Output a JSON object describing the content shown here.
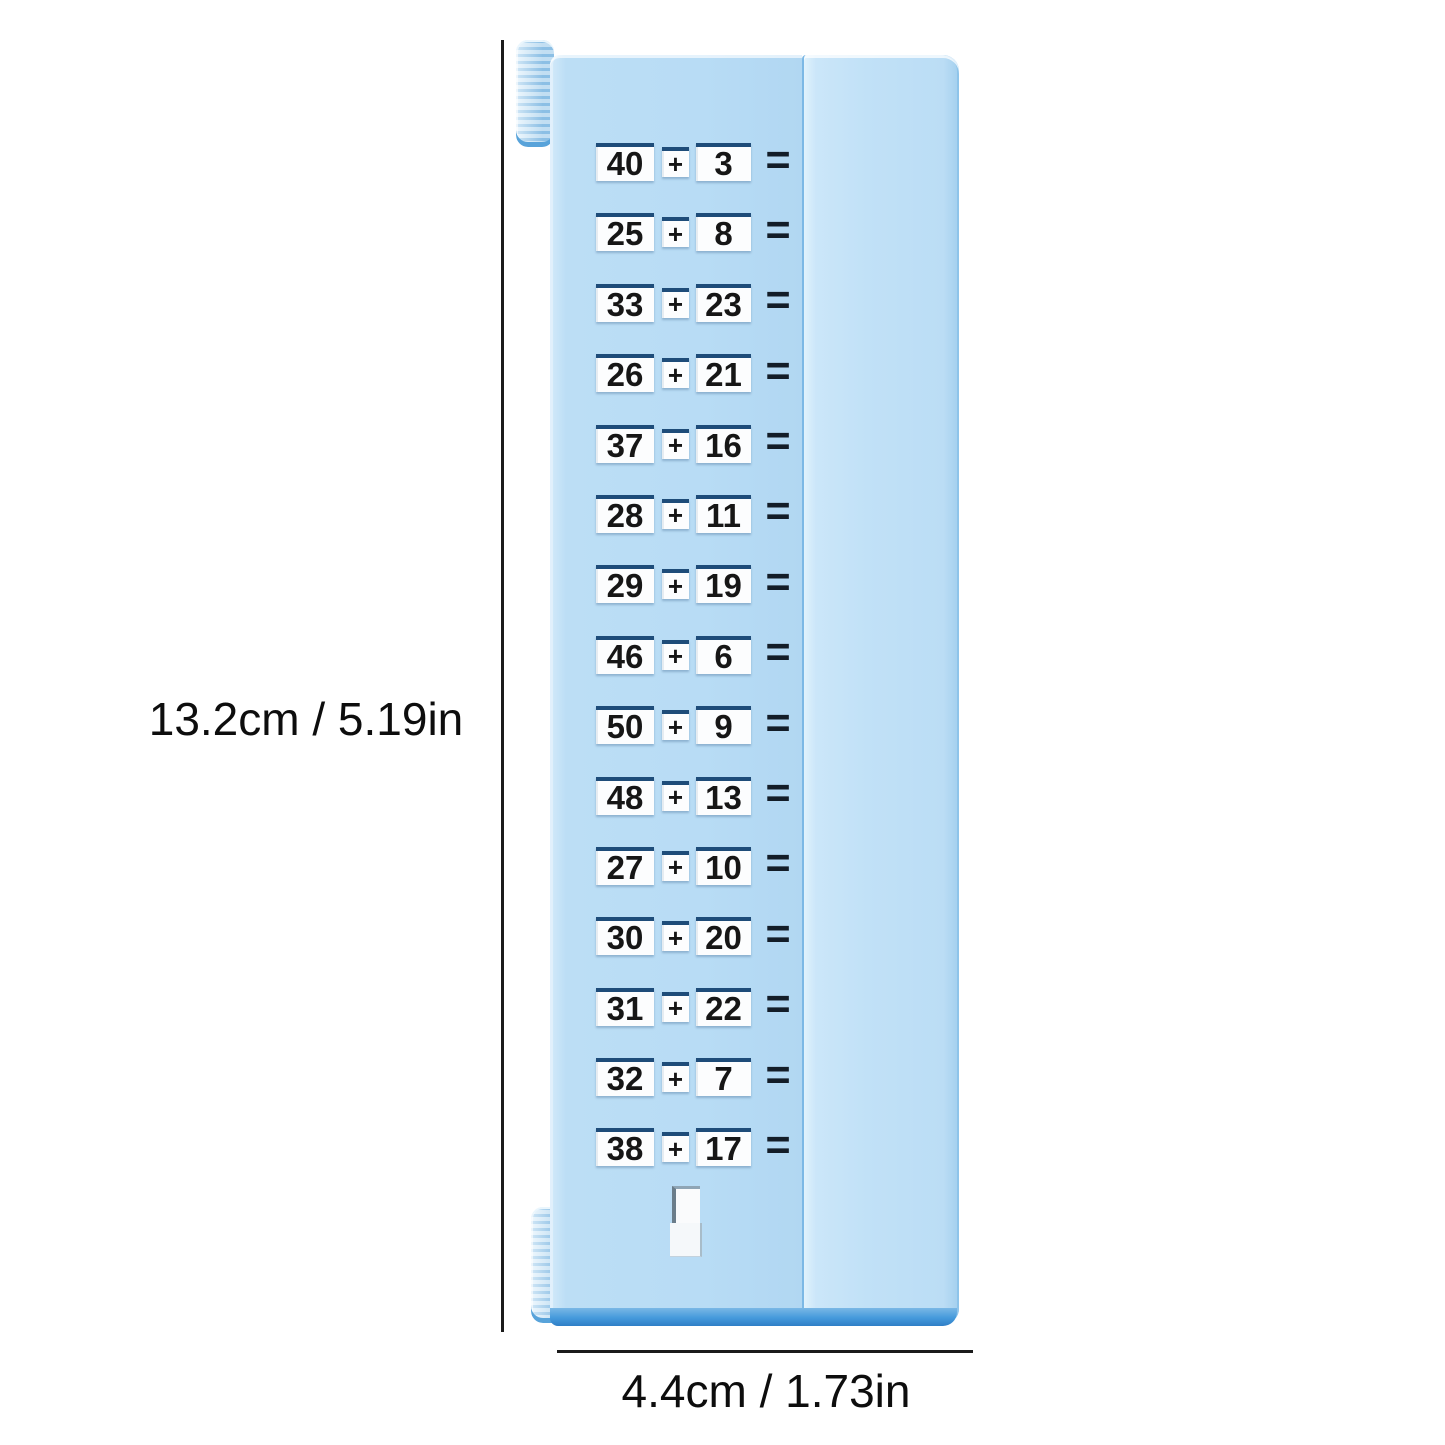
{
  "dimensions": {
    "height_label": "13.2cm / 5.19in",
    "width_label": "4.4cm / 1.73in"
  },
  "device": {
    "equations": [
      {
        "a": "40",
        "op": "+",
        "b": "3",
        "eq": "="
      },
      {
        "a": "25",
        "op": "+",
        "b": "8",
        "eq": "="
      },
      {
        "a": "33",
        "op": "+",
        "b": "23",
        "eq": "="
      },
      {
        "a": "26",
        "op": "+",
        "b": "21",
        "eq": "="
      },
      {
        "a": "37",
        "op": "+",
        "b": "16",
        "eq": "="
      },
      {
        "a": "28",
        "op": "+",
        "b": "11",
        "eq": "="
      },
      {
        "a": "29",
        "op": "+",
        "b": "19",
        "eq": "="
      },
      {
        "a": "46",
        "op": "+",
        "b": "6",
        "eq": "="
      },
      {
        "a": "50",
        "op": "+",
        "b": "9",
        "eq": "="
      },
      {
        "a": "48",
        "op": "+",
        "b": "13",
        "eq": "="
      },
      {
        "a": "27",
        "op": "+",
        "b": "10",
        "eq": "="
      },
      {
        "a": "30",
        "op": "+",
        "b": "20",
        "eq": "="
      },
      {
        "a": "31",
        "op": "+",
        "b": "22",
        "eq": "="
      },
      {
        "a": "32",
        "op": "+",
        "b": "7",
        "eq": "="
      },
      {
        "a": "38",
        "op": "+",
        "b": "17",
        "eq": "="
      }
    ],
    "colors": {
      "body_blue": "#b8dcf5",
      "panel_highlight": "#d9eefb",
      "seam_blue": "#7cb8e5",
      "tile_top_navy": "#1e4c79",
      "digit_black": "#161616",
      "equals_dark": "#131d28",
      "base_strip_blue": "#2f7ec6",
      "dimension_line_black": "#1b1b1b"
    }
  }
}
